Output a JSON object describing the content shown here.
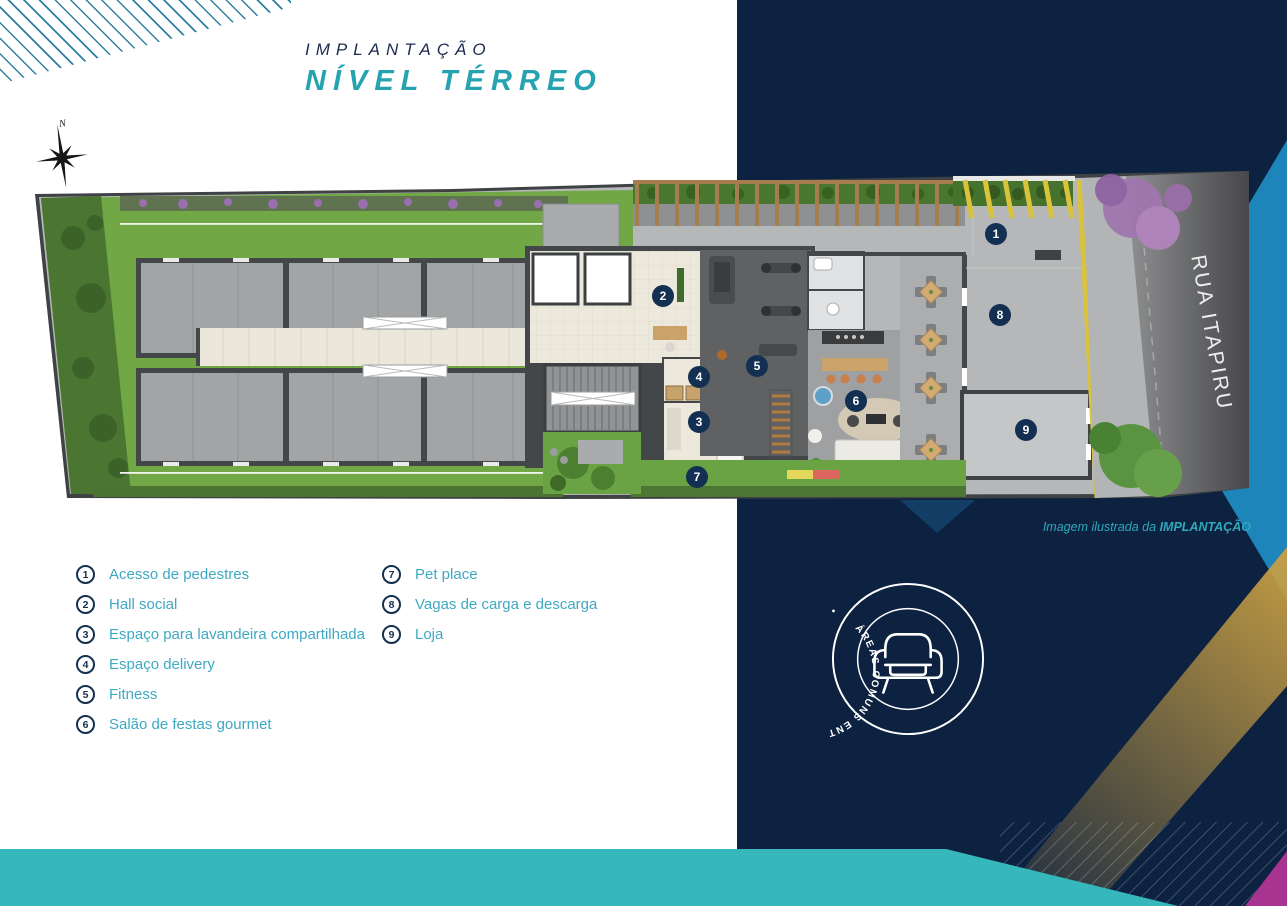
{
  "title": {
    "kicker": "IMPLANTAÇÃO",
    "heading": "NÍVEL TÉRREO"
  },
  "compass": {
    "label": "N"
  },
  "plan": {
    "street_label": "RUA ITAPIRU",
    "markers": [
      {
        "n": "1"
      },
      {
        "n": "2"
      },
      {
        "n": "3"
      },
      {
        "n": "4"
      },
      {
        "n": "5"
      },
      {
        "n": "6"
      },
      {
        "n": "7"
      },
      {
        "n": "8"
      },
      {
        "n": "9"
      }
    ]
  },
  "caption": {
    "prefix": "Imagem ilustrada da ",
    "bold": "IMPLANTAÇÃO"
  },
  "legend": {
    "items": [
      {
        "num": "1",
        "label": "Acesso de pedestres"
      },
      {
        "num": "2",
        "label": "Hall social"
      },
      {
        "num": "3",
        "label": "Espaço para lavandeira compartilhada"
      },
      {
        "num": "4",
        "label": "Espaço delivery"
      },
      {
        "num": "5",
        "label": "Fitness"
      },
      {
        "num": "6",
        "label": "Salão de festas gourmet"
      },
      {
        "num": "7",
        "label": "Pet place"
      },
      {
        "num": "8",
        "label": "Vagas de carga e descarga"
      },
      {
        "num": "9",
        "label": "Loja"
      }
    ]
  },
  "stamp": {
    "text": "ÁREAS COMUNS ENTREGUES EQUIPADAS E DECORADAS  •",
    "icon": "armchair-icon"
  },
  "colors": {
    "teal_accent": "#26a3b0",
    "navy": "#0d2140",
    "legend_text": "#3ea9c2",
    "badge_navy": "#132f52",
    "gold": "#c89f43",
    "magenta": "#a93390",
    "light_blue": "#1d85ba",
    "teal_band": "#35b7bc",
    "curb_yellow": "#d9c23c"
  }
}
